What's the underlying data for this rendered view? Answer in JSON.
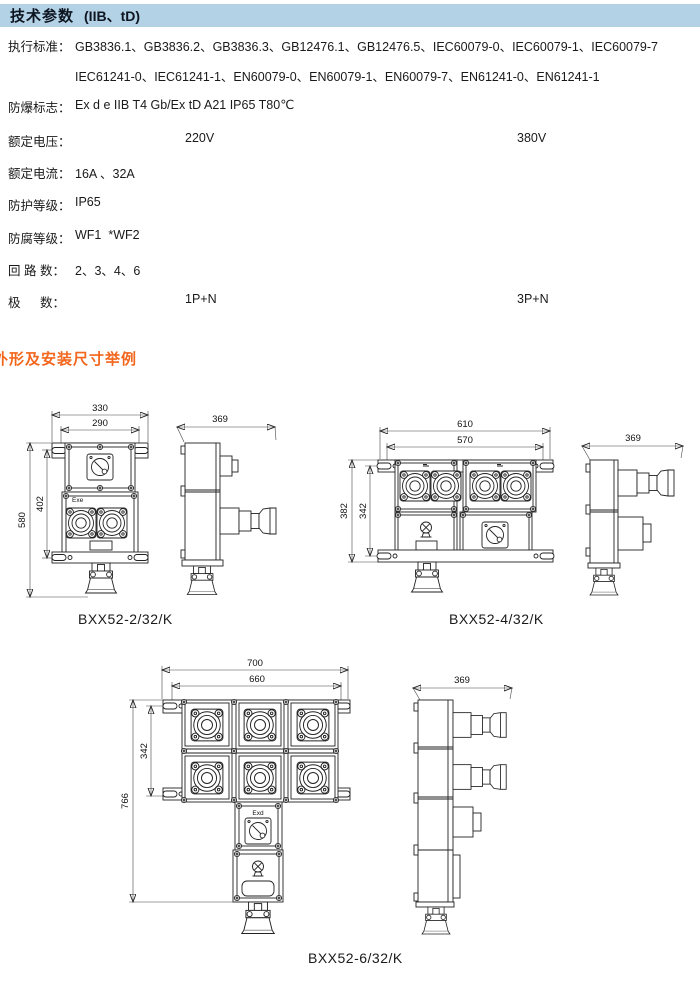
{
  "header": {
    "title": "技术参数",
    "subtitle": "(IIB、tD)"
  },
  "specs": [
    {
      "label": "执行标准：",
      "value": "GB3836.1、GB3836.2、GB3836.3、GB12476.1、GB12476.5、IEC60079-0、IEC60079-1、IEC60079-7"
    },
    {
      "label": "",
      "value": "IEC61241-0、IEC61241-1、EN60079-0、EN60079-1、EN60079-7、EN61241-0、EN61241-1"
    },
    {
      "label": "防爆标志：",
      "value": "Ex d e IIB T4 Gb/Ex tD A21 IP65 T80℃"
    },
    {
      "label": "额定电压：",
      "value": "220V",
      "value2": "380V"
    },
    {
      "label": "额定电流：",
      "value": "16A 、32A"
    },
    {
      "label": "防护等级：",
      "value": "IP65"
    },
    {
      "label": "防腐等级：",
      "value": "WF1  *WF2"
    },
    {
      "label": "回 路 数：",
      "value": "2、3、4、6"
    },
    {
      "label": "极　  数：",
      "value": "1P+N",
      "value2": "3P+N"
    }
  ],
  "section_title": "外形及安装尺寸举例",
  "figures": [
    {
      "caption": "BXX52-2/32/K",
      "marking": "Exe",
      "dims": {
        "outer_w": "330",
        "inner_w": "290",
        "outer_h": "580",
        "inner_h": "402",
        "depth": "369"
      }
    },
    {
      "caption": "BXX52-4/32/K",
      "dims": {
        "outer_w": "610",
        "inner_w": "570",
        "outer_h": "382",
        "inner_h": "342",
        "depth": "369"
      }
    },
    {
      "caption": "BXX52-6/32/K",
      "marking": "Exd",
      "dims": {
        "outer_w": "700",
        "inner_w": "660",
        "outer_h": "766",
        "inner_h": "342",
        "depth": "369"
      }
    }
  ],
  "colors": {
    "header_bg": "#b4d2e6",
    "accent_orange": "#f2661d",
    "drawing_line": "#222222"
  }
}
